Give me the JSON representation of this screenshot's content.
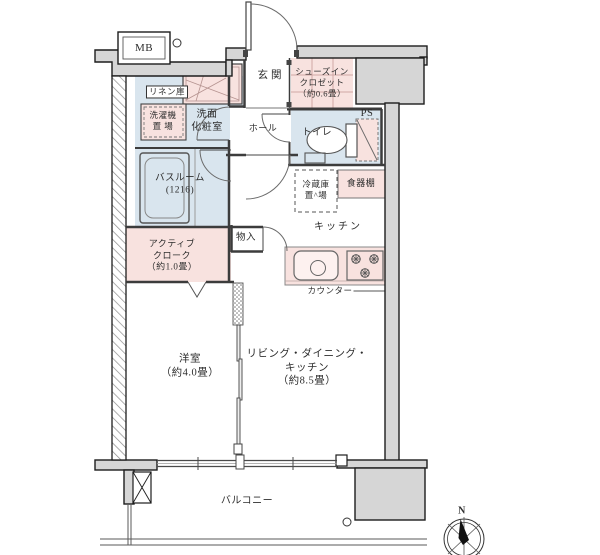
{
  "colors": {
    "pink": "#f8e2df",
    "blue": "#d9e5ee",
    "wall": "#d6d6d6"
  },
  "labels": {
    "mb": "MB",
    "ps": "PS",
    "entrance": "玄関",
    "hall": "ホール",
    "shoe_closet": "シューズイン\nクロゼット\n（約0.6畳）",
    "toilet": "トイレ",
    "linen": "リネン庫",
    "washer": "洗濯機\n置 場",
    "vanity": "洗面\n化粧室",
    "bath": "バスルーム\n(1216)",
    "active_cloak": "アクティブ\nクローク\n（約1.0畳）",
    "storage": "物入",
    "fridge": "冷蔵庫\n置^場",
    "cupboard": "食器棚",
    "kitchen": "キッチン",
    "counter": "カウンター",
    "western_room": "洋室\n（約4.0畳）",
    "ldk": "リビング・ダイニング・\nキッチン\n（約8.5畳）",
    "balcony": "バルコニー",
    "compass_north": "N"
  }
}
